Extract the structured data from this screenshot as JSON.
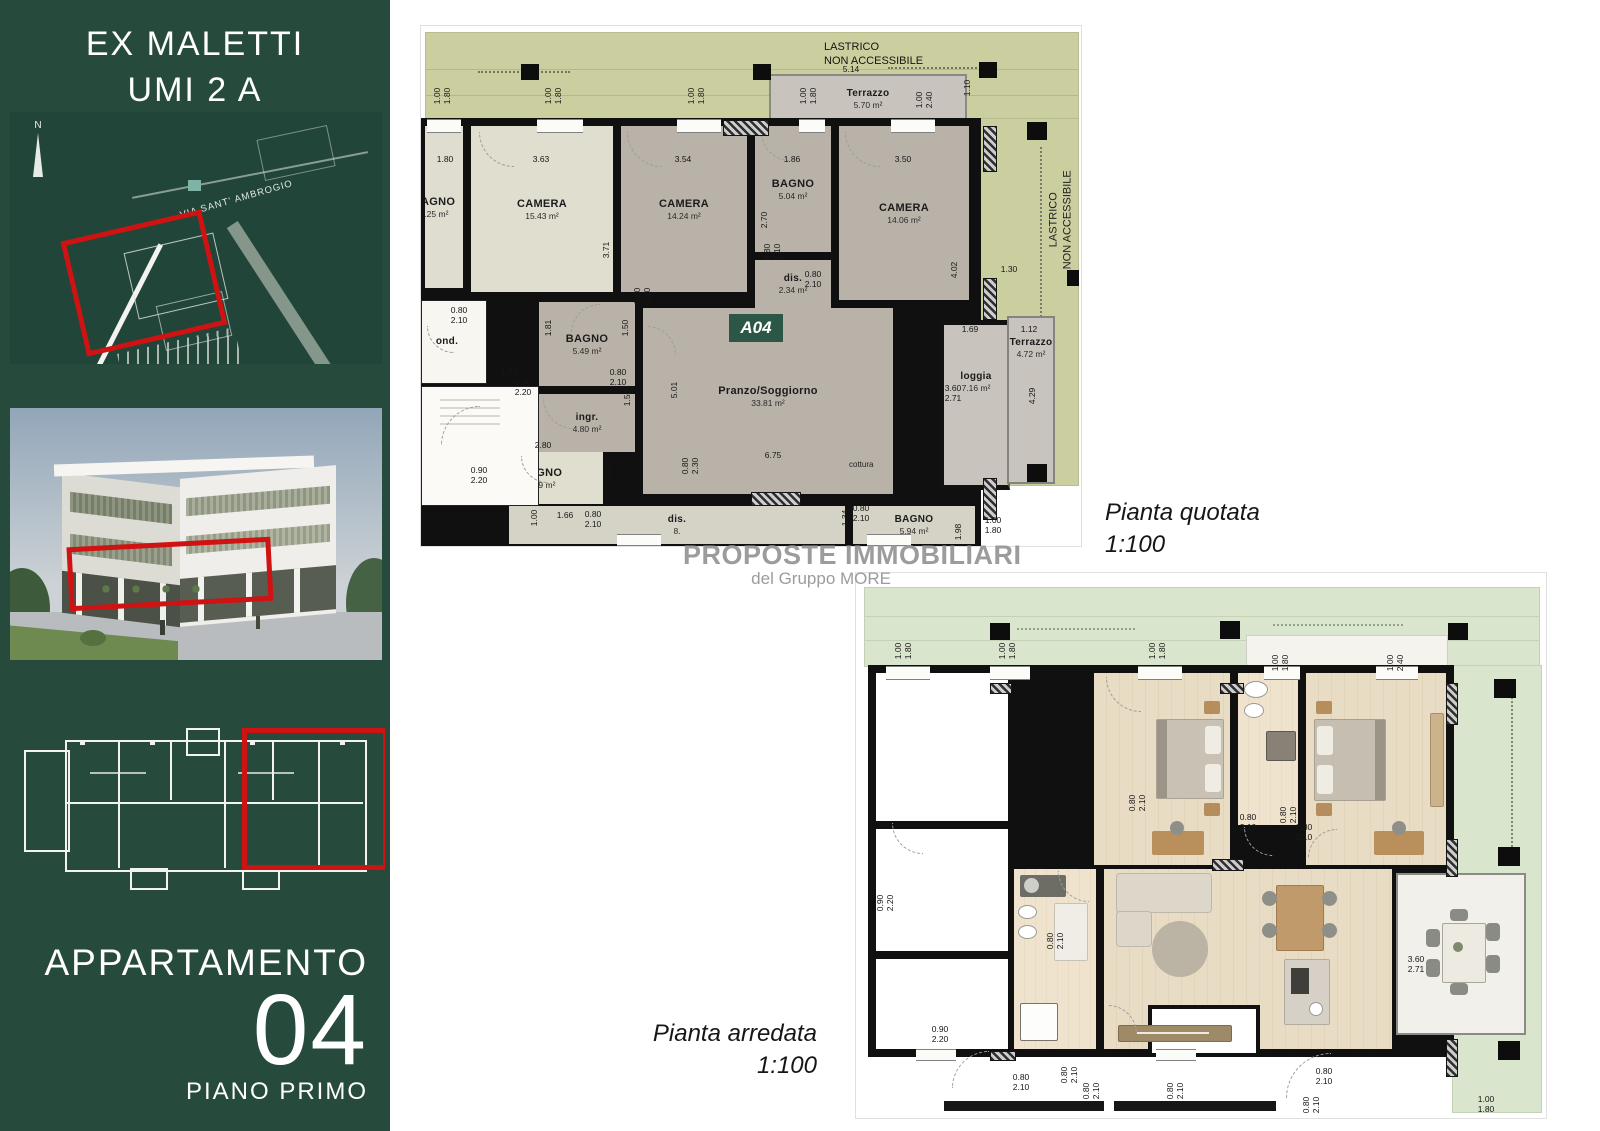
{
  "colors": {
    "sidebar_green": "#264a3c",
    "accent_red": "#cf1212",
    "lastrico_olive": "#cbcfa0",
    "grass_green": "#d9e5cc",
    "badge_green": "#2c5747"
  },
  "sidebar": {
    "title1": "EX MALETTI",
    "title2": "UMI 2 A",
    "apartment_label": "APPARTAMENTO",
    "apartment_number": "04",
    "floor_label": "PIANO PRIMO",
    "map": {
      "street": "VIA SANT' AMBROGIO",
      "north": "N"
    }
  },
  "watermark": {
    "line1": "PROPOSTE IMMOBILIARI",
    "line2": "del Gruppo MORE"
  },
  "plans": {
    "quotata": {
      "caption_line1": "Pianta quotata",
      "caption_line2": "1:100",
      "badge": "A04",
      "cottura": "cottura",
      "lastrico_top": "LASTRICO\nNON ACCESSIBILE",
      "lastrico_right": "LASTRICO\nNON ACCESSIBILE",
      "rooms": [
        {
          "name": "BAGNO",
          "area": "7.25 m²"
        },
        {
          "name": "CAMERA",
          "area": "15.43 m²"
        },
        {
          "name": "CAMERA",
          "area": "14.24 m²"
        },
        {
          "name": "BAGNO",
          "area": "5.04 m²"
        },
        {
          "name": "dis.",
          "area": "2.34 m²"
        },
        {
          "name": "CAMERA",
          "area": "14.06 m²"
        },
        {
          "name": "Terrazzo",
          "area": "5.70 m²"
        },
        {
          "name": "BAGNO",
          "area": "5.49 m²"
        },
        {
          "name": "ingr.",
          "area": "4.80 m²"
        },
        {
          "name": "Pranzo/Soggiorno",
          "area": "33.81 m²"
        },
        {
          "name": "BAGNO",
          "area": "4.19 m²"
        },
        {
          "name": "dis.",
          "area": "8."
        },
        {
          "name": "BAGNO",
          "area": "5.94 m²"
        },
        {
          "name": "loggia",
          "area": "7.16 m²"
        },
        {
          "name": "Terrazzo",
          "area": "4.72 m²"
        },
        {
          "name": "ond.",
          "area": ""
        }
      ],
      "dims": [
        {
          "t": "1.00\n1.80",
          "x": 22,
          "y": 70,
          "r": 1
        },
        {
          "t": "1.00\n1.80",
          "x": 133,
          "y": 70,
          "r": 1
        },
        {
          "t": "1.00\n1.80",
          "x": 276,
          "y": 70,
          "r": 1
        },
        {
          "t": "1.00\n1.80",
          "x": 388,
          "y": 70,
          "r": 1
        },
        {
          "t": "1.00\n2.40",
          "x": 504,
          "y": 74,
          "r": 1
        },
        {
          "t": "5.14",
          "x": 430,
          "y": 44
        },
        {
          "t": "1.10",
          "x": 547,
          "y": 62,
          "r": 1
        },
        {
          "t": "1.80",
          "x": 24,
          "y": 134
        },
        {
          "t": "3.63",
          "x": 120,
          "y": 134
        },
        {
          "t": "3.54",
          "x": 262,
          "y": 134
        },
        {
          "t": "1.86",
          "x": 371,
          "y": 134
        },
        {
          "t": "3.50",
          "x": 482,
          "y": 134
        },
        {
          "t": "3.71",
          "x": 186,
          "y": 224,
          "r": 1
        },
        {
          "t": "2.70",
          "x": 344,
          "y": 194,
          "r": 1
        },
        {
          "t": "4.02",
          "x": 534,
          "y": 244,
          "r": 1
        },
        {
          "t": "0.80\n2.10",
          "x": 352,
          "y": 226,
          "r": 1
        },
        {
          "t": "0.80\n2.10",
          "x": 392,
          "y": 254
        },
        {
          "t": "1.81",
          "x": 128,
          "y": 302,
          "r": 1
        },
        {
          "t": "1.50",
          "x": 205,
          "y": 302,
          "r": 1
        },
        {
          "t": "0.80\n2.10",
          "x": 222,
          "y": 270,
          "r": 1
        },
        {
          "t": "0.80\n2.10",
          "x": 38,
          "y": 290
        },
        {
          "t": "1.50",
          "x": 88,
          "y": 346
        },
        {
          "t": "0.90\n2.20",
          "x": 102,
          "y": 362
        },
        {
          "t": "0.80\n2.10",
          "x": 197,
          "y": 352
        },
        {
          "t": "1.50",
          "x": 207,
          "y": 372,
          "r": 1
        },
        {
          "t": "5.01",
          "x": 254,
          "y": 364,
          "r": 1
        },
        {
          "t": "6.75",
          "x": 352,
          "y": 430
        },
        {
          "t": "2.80",
          "x": 122,
          "y": 420
        },
        {
          "t": "1.50",
          "x": 188,
          "y": 448,
          "r": 1
        },
        {
          "t": "0.90\n2.20",
          "x": 58,
          "y": 450
        },
        {
          "t": "1.66",
          "x": 144,
          "y": 490
        },
        {
          "t": "0.80\n2.10",
          "x": 172,
          "y": 494
        },
        {
          "t": "1.00",
          "x": 114,
          "y": 492,
          "r": 1
        },
        {
          "t": "0.80\n2.30",
          "x": 270,
          "y": 440,
          "r": 1
        },
        {
          "t": "0.80\n2.10",
          "x": 440,
          "y": 488
        },
        {
          "t": "1.34",
          "x": 425,
          "y": 492,
          "r": 1
        },
        {
          "t": "1.98",
          "x": 538,
          "y": 506,
          "r": 1
        },
        {
          "t": "1.69",
          "x": 549,
          "y": 304
        },
        {
          "t": "1.12",
          "x": 608,
          "y": 304
        },
        {
          "t": "3.60\n2.71",
          "x": 532,
          "y": 368
        },
        {
          "t": "4.29",
          "x": 612,
          "y": 370,
          "r": 1
        },
        {
          "t": "1.30",
          "x": 588,
          "y": 244
        },
        {
          "t": "1.00\n1.80",
          "x": 572,
          "y": 500
        }
      ]
    },
    "arredata": {
      "caption_line1": "Pianta arredata",
      "caption_line2": "1:100",
      "dims": [
        {
          "t": "1.00\n1.80",
          "x": 48,
          "y": 78,
          "r": 1
        },
        {
          "t": "1.00\n1.80",
          "x": 152,
          "y": 78,
          "r": 1
        },
        {
          "t": "1.00\n1.80",
          "x": 302,
          "y": 78,
          "r": 1
        },
        {
          "t": "1.00\n1.80",
          "x": 425,
          "y": 90,
          "r": 1
        },
        {
          "t": "1.00\n2.40",
          "x": 540,
          "y": 90,
          "r": 1
        },
        {
          "t": "0.80\n2.10",
          "x": 392,
          "y": 250
        },
        {
          "t": "0.80\n2.10",
          "x": 433,
          "y": 242,
          "r": 1
        },
        {
          "t": "0.80\n2.10",
          "x": 448,
          "y": 260
        },
        {
          "t": "0.80\n2.10",
          "x": 282,
          "y": 230,
          "r": 1
        },
        {
          "t": "0.80\n2.10",
          "x": 200,
          "y": 368,
          "r": 1
        },
        {
          "t": "0.90\n2.20",
          "x": 84,
          "y": 462
        },
        {
          "t": "0.90\n2.20",
          "x": 30,
          "y": 330,
          "r": 1
        },
        {
          "t": "3.60\n2.71",
          "x": 560,
          "y": 392
        },
        {
          "t": "0.80\n2.10",
          "x": 165,
          "y": 510
        },
        {
          "t": "0.80\n2.10",
          "x": 214,
          "y": 502,
          "r": 1
        },
        {
          "t": "0.80\n2.10",
          "x": 236,
          "y": 518,
          "r": 1
        },
        {
          "t": "0.80\n2.10",
          "x": 320,
          "y": 518,
          "r": 1
        },
        {
          "t": "0.80\n2.10",
          "x": 468,
          "y": 504
        },
        {
          "t": "0.80\n2.10",
          "x": 456,
          "y": 532,
          "r": 1
        },
        {
          "t": "1.00\n1.80",
          "x": 630,
          "y": 532
        }
      ]
    }
  }
}
